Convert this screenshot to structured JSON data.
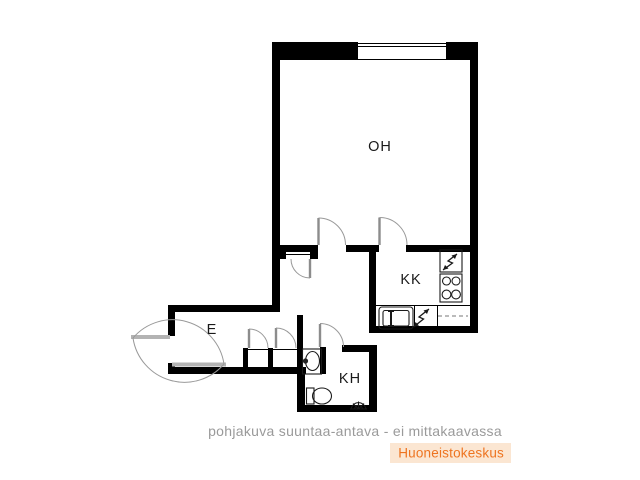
{
  "rooms": {
    "living": "OH",
    "kitchenette": "KK",
    "hallway": "E",
    "bathroom": "KH"
  },
  "caption": "pohjakuva suuntaa-antava - ei mittakaavassa",
  "brand": {
    "name": "Huoneistokeskus",
    "color": "#ee7420",
    "bg": "#fbe6d2"
  },
  "colors": {
    "wall": "#000000",
    "door": "#999999",
    "caption_text": "#9a9a9a",
    "background": "#ffffff"
  }
}
